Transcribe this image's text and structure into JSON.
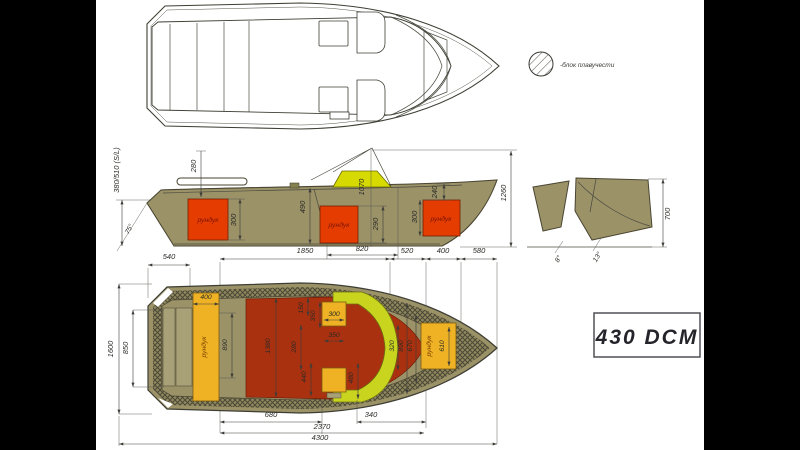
{
  "colors": {
    "background": "#000000",
    "paper": "#ffffff",
    "hull_olive": "#9b9268",
    "bench_olive": "#a8a077",
    "console_yellow": "#d6da00",
    "console_green": "#c9d41f",
    "locker_red": "#e53c02",
    "deck_red": "#a93110",
    "locker_orange": "#eeb224",
    "line": "#3e3e34"
  },
  "legend": {
    "label": "-блок плавучести"
  },
  "model_box": {
    "label": "430 DCM"
  },
  "labels": {
    "locker": "рундук"
  },
  "side_view": {
    "freeboard": "380/510 (S/L)",
    "stern_angle": "75°",
    "d280": "280",
    "d300_stern": "300",
    "d490": "490",
    "d290": "290",
    "d1070": "1070",
    "d820": "820",
    "d300_bow": "300",
    "d240": "240",
    "d1260": "1260"
  },
  "transom_view": {
    "d700": "700",
    "deadrise_8": "8°",
    "deadrise_13": "13°"
  },
  "length_dims": {
    "d540": "540",
    "d1850": "1850",
    "d520": "520",
    "d400": "400",
    "d580": "580"
  },
  "bottom_view": {
    "d1600": "1600",
    "d850": "850",
    "d400": "400",
    "d890_left": "890",
    "d1380": "1380",
    "d150": "150",
    "d350_top": "350",
    "d300_seat": "300",
    "d350_mid": "350",
    "d280": "280",
    "d440": "440",
    "d480": "480",
    "d320": "320",
    "d890_right": "890",
    "d670": "670",
    "d610": "610",
    "d680": "680",
    "d340": "340",
    "d2370": "2370",
    "d4300": "4300"
  }
}
